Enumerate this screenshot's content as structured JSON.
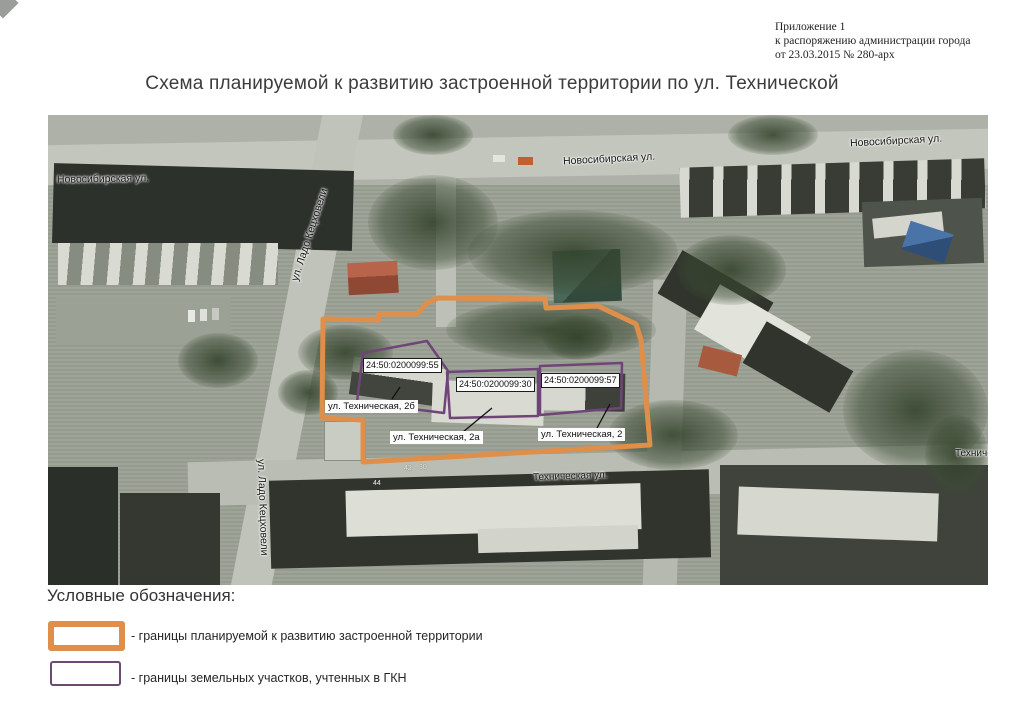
{
  "appendix": {
    "line1": "Приложение 1",
    "line2": "к распоряжению администрации города",
    "line3": "от 23.03.2015 № 280-арх"
  },
  "title": "Схема планируемой к развитию застроенной территории по ул. Технической",
  "map": {
    "streets": {
      "novosibirskaya_left": "Новосибирская ул.",
      "novosibirskaya_middle": "Новосибирская ул.",
      "novosibirskaya_right": "Новосибирская ул.",
      "lado_ketskhoveli_upper": "ул. Ладо Кецховели",
      "lado_ketskhoveli_lower": "ул. Ладо Кецховели",
      "tekhnicheskaya": "Техническая ул.",
      "tekhnicheskaya_right_clipped": "Техническая ул."
    },
    "house_numbers": {
      "n44": "44",
      "n42": "42",
      "n30": "30"
    },
    "parcels": [
      {
        "cadastral_number": "24:50:0200099:55",
        "address": "ул. Техническая, 2б"
      },
      {
        "cadastral_number": "24:50:0200099:30",
        "address": "ул. Техническая, 2а"
      },
      {
        "cadastral_number": "24:50:0200099:57",
        "address": "ул. Техническая, 2"
      }
    ],
    "boundary_colors": {
      "territory": "#DF8F4A",
      "parcel": "#6F4578"
    }
  },
  "legend": {
    "title": "Условные обозначения:",
    "items": [
      {
        "label": "- границы планируемой к развитию застроенной территории",
        "swatch_color": "#DF8F4A"
      },
      {
        "label": "- границы земельных участков, учтенных в ГКН",
        "swatch_color": "#6B4A75"
      }
    ]
  }
}
